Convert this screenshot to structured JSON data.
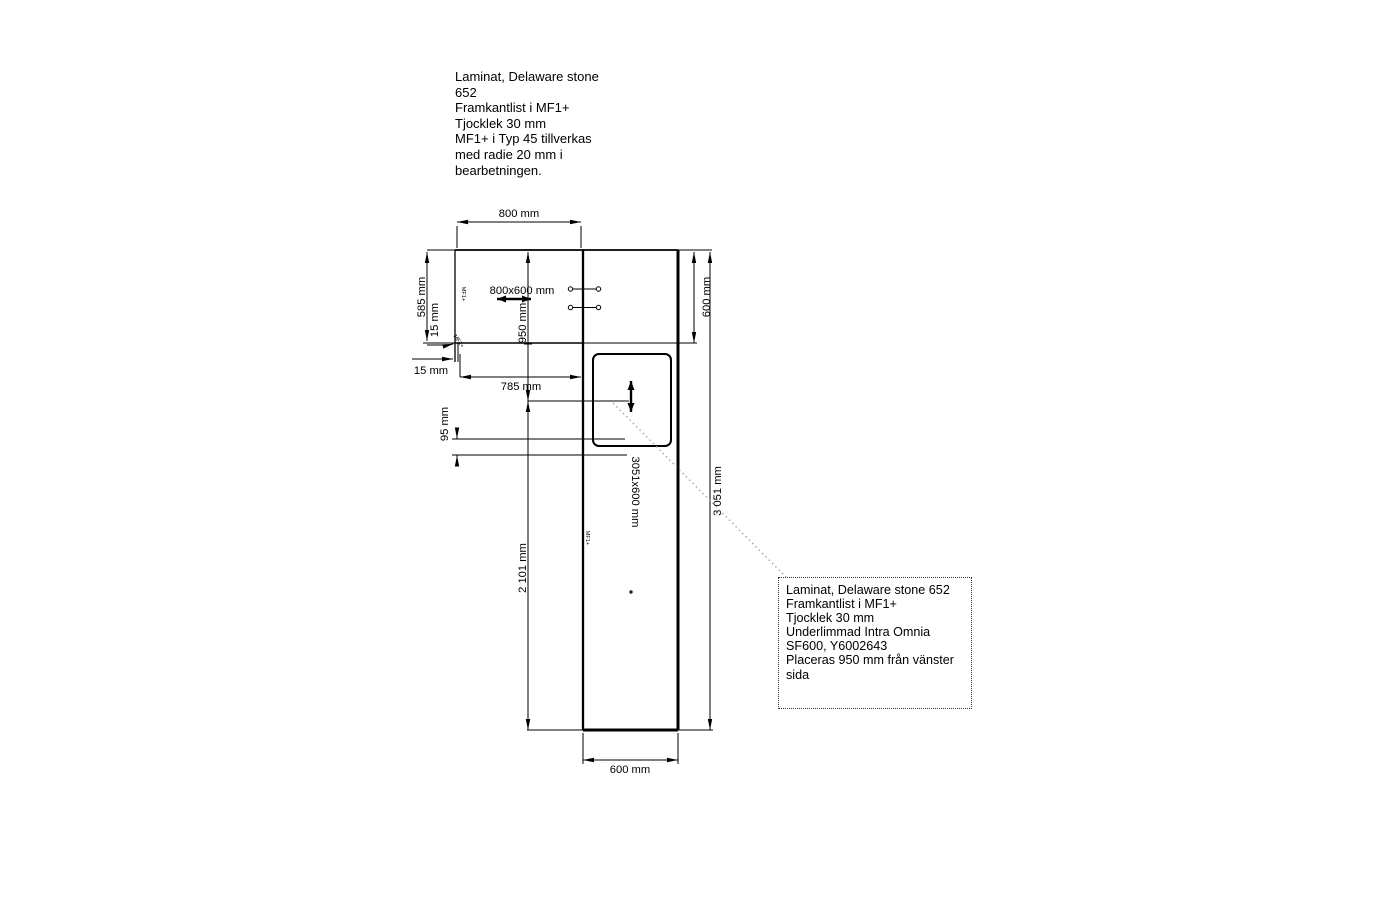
{
  "top_note": {
    "lines": [
      "Laminat, Delaware stone",
      "652",
      "Framkantlist i MF1+",
      "Tjocklek 30 mm",
      "MF1+ i Typ 45 tillverkas",
      "med radie 20 mm i",
      "bearbetningen."
    ]
  },
  "callout": {
    "lines": [
      "Laminat, Delaware stone 652",
      "Framkantlist i MF1+",
      "Tjocklek 30 mm",
      "Underlimmad Intra Omnia",
      "SF600, Y6002643",
      "Placeras 950 mm från vänster",
      "sida"
    ]
  },
  "dims": {
    "top_width": "800 mm",
    "left_height": "585 mm",
    "edge_left": "15 mm",
    "edge_bottom": "15 mm",
    "front_width": "785 mm",
    "sink_gap": "95 mm",
    "sink_center_from_top": "950 mm",
    "lower_length": "2 101 mm",
    "right_depth": "600 mm",
    "total_length": "3 051 mm",
    "bottom_width": "600 mm"
  },
  "labels": {
    "piece1": "800x600 mm",
    "piece2": "3051x600 mm",
    "edge_front": "MF1+",
    "edge_side": "MF1+",
    "edge_corner": "MF1+"
  },
  "colors": {
    "line": "#000000",
    "leader": "#9e9e9e",
    "text": "#000000"
  }
}
